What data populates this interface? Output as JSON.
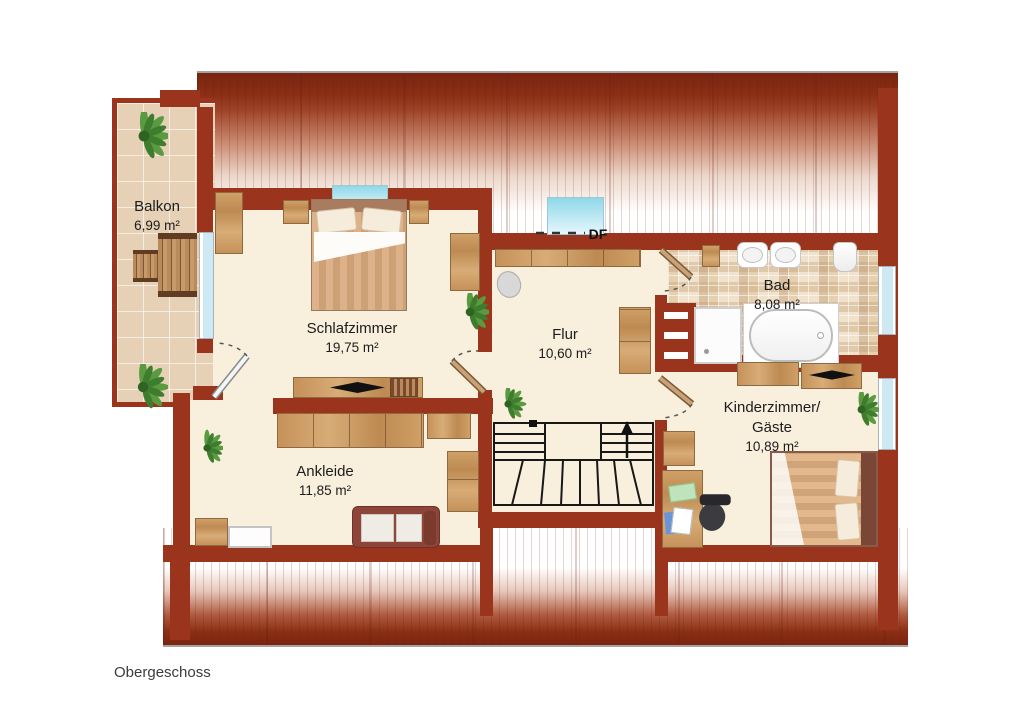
{
  "title": "Obergeschoss",
  "skylight": {
    "label": "DF"
  },
  "rooms": {
    "balkon": {
      "name": "Balkon",
      "area": "6,99 m²"
    },
    "schlafzimmer": {
      "name": "Schlafzimmer",
      "area": "19,75 m²"
    },
    "flur": {
      "name": "Flur",
      "area": "10,60 m²"
    },
    "bad": {
      "name": "Bad",
      "area": "8,08 m²"
    },
    "kinderzimmer": {
      "name_line1": "Kinderzimmer/",
      "name_line2": "Gäste",
      "area": "10,89 m²"
    },
    "ankleide": {
      "name": "Ankleide",
      "area": "11,85 m²"
    }
  },
  "colors": {
    "wall": "#9a341c",
    "floor": "#f9efdd",
    "roof_dark": "#7a2410",
    "window_glass": "#cdeaf4",
    "accent_wood": "#c89a66"
  }
}
